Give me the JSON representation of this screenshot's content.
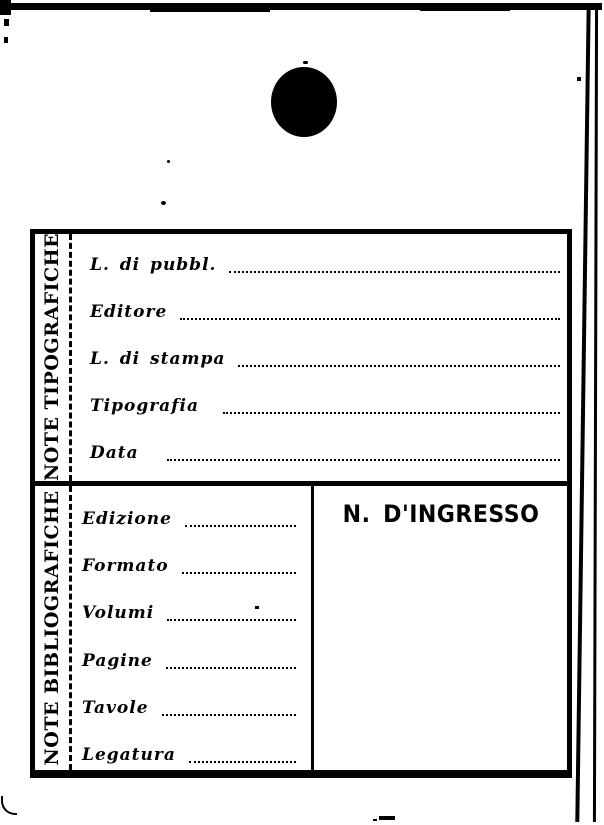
{
  "card": {
    "note_tipografiche": {
      "section_label": "NOTE TIPOGRAFICHE",
      "fields": [
        {
          "label": "L. di pubbl.",
          "value": ""
        },
        {
          "label": "Editore",
          "value": ""
        },
        {
          "label": "L. di stampa",
          "value": ""
        },
        {
          "label": "Tipografia",
          "value": ""
        },
        {
          "label": "Data",
          "value": ""
        }
      ]
    },
    "note_bibliografiche": {
      "section_label": "NOTE BIBLIOGRAFICHE",
      "fields": [
        {
          "label": "Edizione",
          "value": ""
        },
        {
          "label": "Formato",
          "value": ""
        },
        {
          "label": "Volumi",
          "value": ""
        },
        {
          "label": "Pagine",
          "value": ""
        },
        {
          "label": "Tavole",
          "value": ""
        },
        {
          "label": "Legatura",
          "value": ""
        }
      ]
    },
    "ingresso": {
      "label": "N. D'INGRESSO",
      "value": ""
    }
  },
  "colors": {
    "ink": "#000000",
    "paper": "#ffffff"
  }
}
